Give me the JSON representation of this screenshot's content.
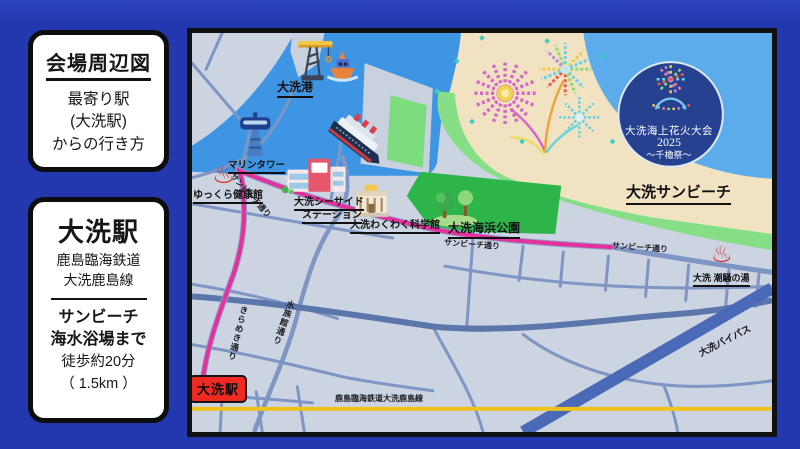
{
  "sidebar": {
    "venue_box": {
      "title": "会場周辺図",
      "line1": "最寄り駅",
      "line2": "(大洗駅)",
      "line3": "からの行き方"
    },
    "station_box": {
      "station_name": "大洗駅",
      "railway_line1": "鹿島臨海鉄道",
      "railway_line2": "大洗鹿島線",
      "dest_line1": "サンビーチ",
      "dest_line2": "海水浴場まで",
      "walk_line1": "徒歩約20分",
      "walk_line2": "（ 1.5km ）"
    }
  },
  "map": {
    "labels": {
      "port": "大洗港",
      "marine_tower": "マリンタワー",
      "yukkura": "ゆっくら健康館",
      "seaside_line1": "大洗シーサイド",
      "seaside_line2": "ステーション",
      "science": "大洗わくわく科学館",
      "park": "大洗海浜公園",
      "sun_beach": "大洗サンビーチ",
      "shiosai": "大洗 潮騒の湯",
      "bypass": "大洗バイパス",
      "kirameki_street": "きらめき通り",
      "aquarium_street": "水族館通り",
      "sunbeach_street_diag": "サンビーチ通り",
      "sunbeach_street_1": "サンビーチ通り",
      "sunbeach_street_2": "サンビーチ通り",
      "railway": "鹿島臨海鉄道大洗鹿島線",
      "station_badge": "大洗駅",
      "onsen_mark": "♨"
    },
    "logo": {
      "title": "大洗海上花火大会",
      "year": "2025",
      "subtitle": "〜千櫓祭〜"
    },
    "colors": {
      "background_blue": "#2337ae",
      "harbor_water": "#3e95e4",
      "sea": "#5cabea",
      "sand": "#f1e3c2",
      "band_green": "#86df86",
      "park_green": "#2db54a",
      "land_gray": "#ccd4e1",
      "road": "#7e96c4",
      "bypass_road": "#4a69b7",
      "route_pink": "#e8309c",
      "railway_yellow": "#f0c31c",
      "station_red": "#ee2a23",
      "logo_navy": "#25418f"
    }
  }
}
